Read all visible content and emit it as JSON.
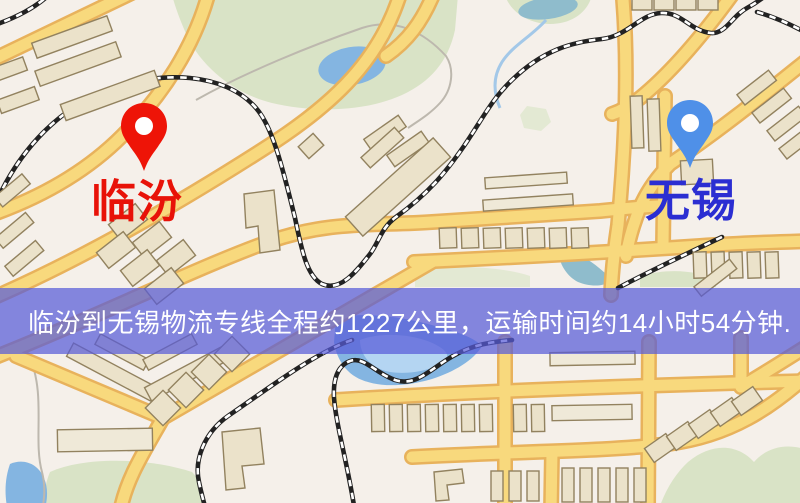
{
  "banner": {
    "text": "临汾到无锡物流专线全程约1227公里，运输时间约14小时54分钟.",
    "background_color": "rgba(88,92,216,0.72)",
    "text_color": "#ffffff"
  },
  "markers": [
    {
      "id": "origin",
      "label": "临汾",
      "pin_icon": "map-pin-icon",
      "pin_color": "#ee1407",
      "pin_hole_color": "#ffffff",
      "label_color": "#e81208"
    },
    {
      "id": "destination",
      "label": "无锡",
      "pin_icon": "map-pin-icon",
      "pin_color": "#4f90e8",
      "pin_hole_color": "#ffffff",
      "label_color": "#2b2ed2"
    }
  ],
  "map": {
    "theme_colors": {
      "background": "#f5f0ea",
      "road_fill": "#f8d97d",
      "road_casing": "#e8b25c",
      "park_green": "#d9e3c6",
      "water_blue": "#8fc0ea",
      "building_fill": "#ebe2ca",
      "railway_black": "#222222"
    }
  }
}
